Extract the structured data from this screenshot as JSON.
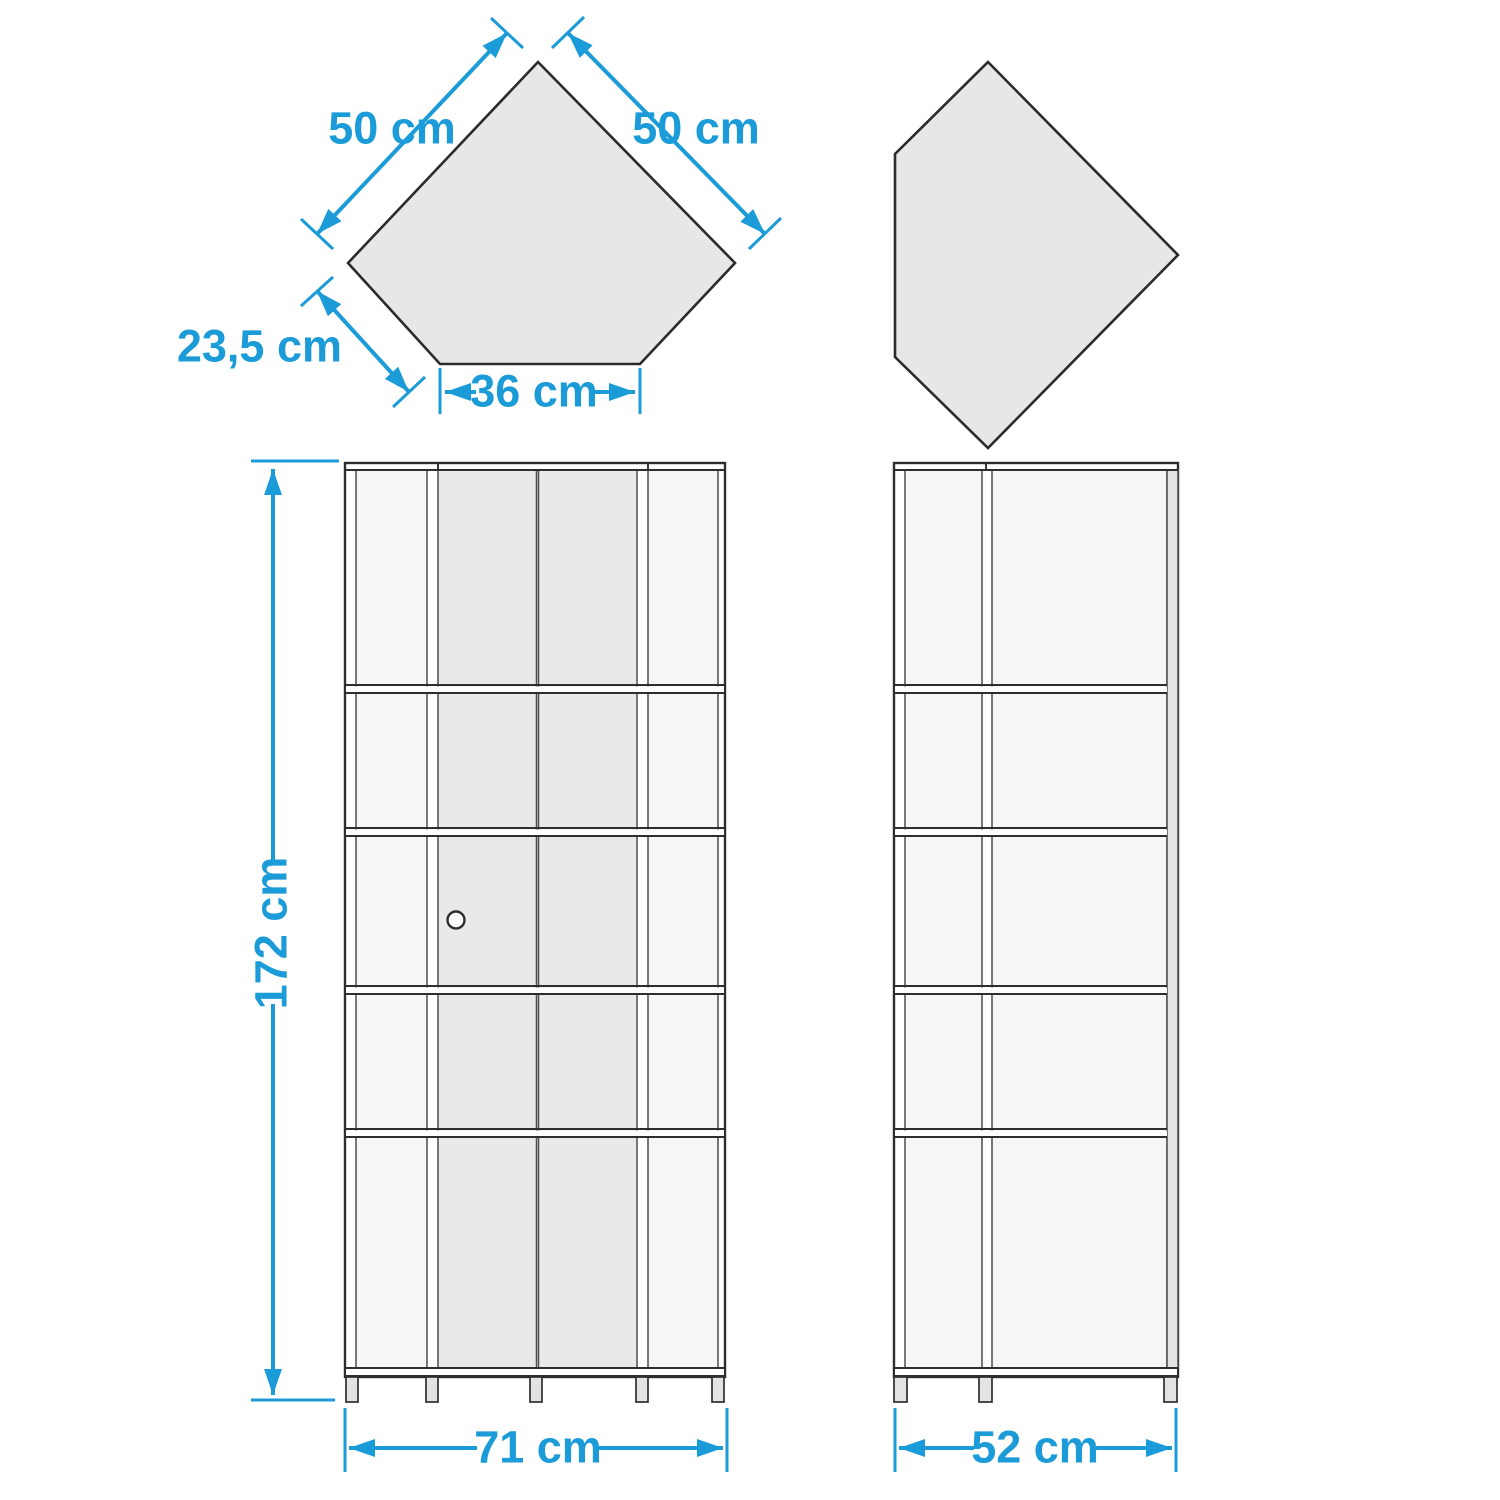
{
  "colors": {
    "accent_blue": "#1b9bd7",
    "shape_fill": "#e7e7e7",
    "panel_light": "#f6f6f6",
    "panel_door": "#e9e9e9",
    "outline_dark": "#2e2e2e"
  },
  "top_view": {
    "left_edge": "50 cm",
    "right_edge": "50 cm",
    "back_left_edge": "23,5 cm",
    "front_edge": "36 cm"
  },
  "front_view": {
    "height": "172 cm",
    "width": "71 cm"
  },
  "side_view": {
    "depth": "52 cm"
  }
}
